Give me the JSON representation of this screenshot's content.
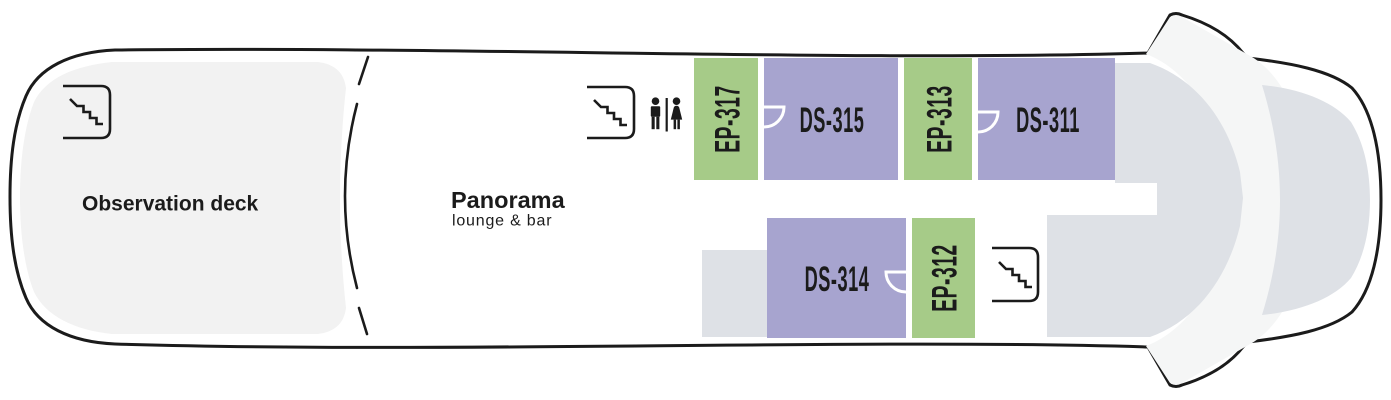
{
  "plan": {
    "observation_deck": {
      "label": "Observation deck"
    },
    "panorama": {
      "title": "Panorama",
      "subtitle": "lounge & bar"
    },
    "cabins": [
      {
        "id": "EP-317",
        "category": "EP",
        "position": "top"
      },
      {
        "id": "DS-315",
        "category": "DS",
        "position": "top"
      },
      {
        "id": "EP-313",
        "category": "EP",
        "position": "top"
      },
      {
        "id": "DS-311",
        "category": "DS",
        "position": "top"
      },
      {
        "id": "DS-314",
        "category": "DS",
        "position": "bottom"
      },
      {
        "id": "EP-312",
        "category": "EP",
        "position": "bottom"
      }
    ],
    "icons": {
      "stairs": [
        "stairs-icon-aft",
        "stairs-icon-midship",
        "stairs-icon-forward"
      ],
      "restroom": "restroom-icon"
    },
    "colors": {
      "ep_green": "#a6cb88",
      "ds_purple": "#a7a4cf",
      "observation_fill": "#f2f2f2",
      "forward_gray": "#dee1e6",
      "crescent_light": "#f5f6f6",
      "outline": "#1b1b1b",
      "text": "#1b1b1b"
    }
  }
}
